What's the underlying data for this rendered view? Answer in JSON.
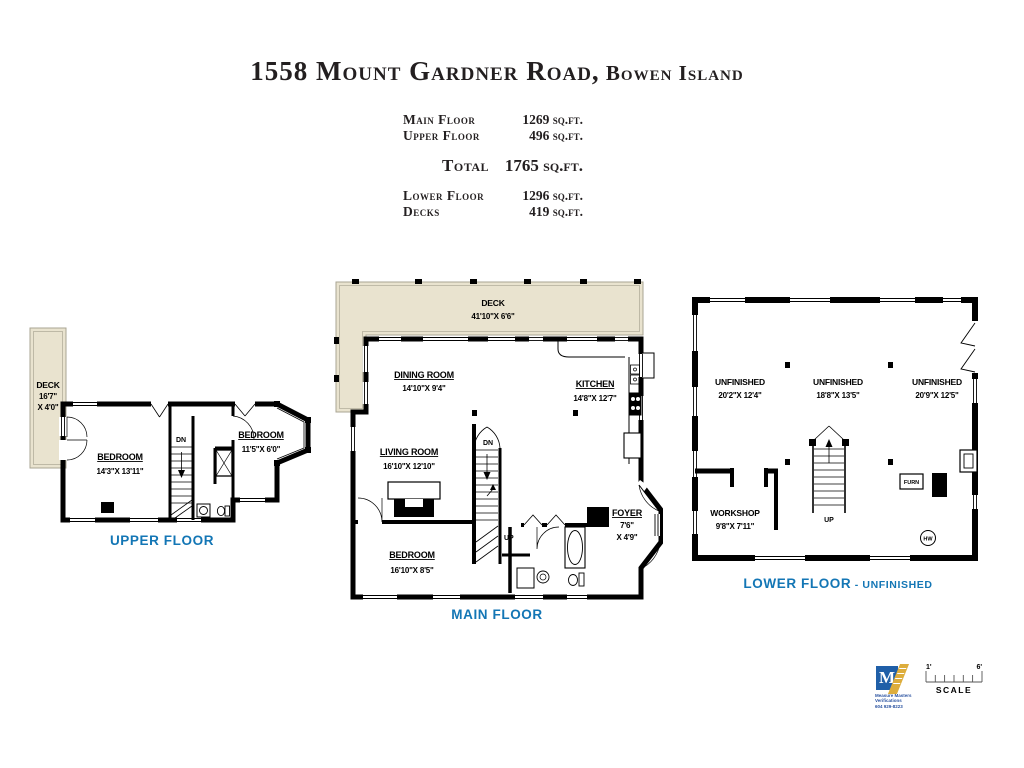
{
  "title": {
    "address": "1558 Mount Gardner Road,",
    "city": " Bowen Island"
  },
  "area_table": {
    "rows_top": [
      {
        "label": "Main Floor",
        "value": "1269 sq.ft."
      },
      {
        "label": "Upper Floor",
        "value": "496 sq.ft."
      }
    ],
    "total_label": "Total",
    "total_value": "1765 sq.ft.",
    "rows_bottom": [
      {
        "label": "Lower Floor",
        "value": "1296 sq.ft."
      },
      {
        "label": "Decks",
        "value": "419 sq.ft."
      }
    ]
  },
  "upper_floor": {
    "caption": "UPPER FLOOR",
    "deck_label": "DECK",
    "deck_dim_1": "16'7\"",
    "deck_dim_2": "X  4'0\"",
    "bedroom1_name": "BEDROOM",
    "bedroom1_dims": "14'3\"X  13'11\"",
    "bedroom2_name": "BEDROOM",
    "bedroom2_dims": "11'5\"X  6'0\"",
    "stairs_down": "DN"
  },
  "main_floor": {
    "caption": "MAIN FLOOR",
    "deck_label": "DECK",
    "deck_dims": "41'10\"X  6'6\"",
    "dining_name": "DINING  ROOM",
    "dining_dims": "14'10\"X  9'4\"",
    "kitchen_name": "KITCHEN",
    "kitchen_dims": "14'8\"X  12'7\"",
    "living_name": "LIVING  ROOM",
    "living_dims": "16'10\"X  12'10\"",
    "bedroom_name": "BEDROOM",
    "bedroom_dims": "16'10\"X  8'5\"",
    "foyer_name": "FOYER",
    "foyer_dim_1": "7'6\"",
    "foyer_dim_2": "X  4'9\"",
    "stairs_down": "DN",
    "stairs_up": "UP"
  },
  "lower_floor": {
    "caption": "LOWER FLOOR",
    "caption_suffix": " - UNFINISHED",
    "unfinished1_name": "UNFINISHED",
    "unfinished1_dims": "20'2\"X  12'4\"",
    "unfinished2_name": "UNFINISHED",
    "unfinished2_dims": "18'8\"X  13'5\"",
    "unfinished3_name": "UNFINISHED",
    "unfinished3_dims": "20'9\"X  12'5\"",
    "workshop_name": "WORKSHOP",
    "workshop_dims": "9'8\"X  7'11\"",
    "furnace_label": "FURN",
    "hot_water_label": "HW",
    "stairs_up": "UP"
  },
  "scale_bar": {
    "left_label": "1'",
    "right_label": "6'",
    "label": "SCALE"
  },
  "logo": {
    "monogram": "M",
    "line1": "Measure Masters Verifications",
    "line2": "604 929-8223"
  },
  "colors": {
    "accent_blue": "#1376b5",
    "deck_fill": "#e9e3cf",
    "wall": "#000000",
    "logo_blue": "#1f5fa8",
    "logo_gold": "#ddad3c"
  }
}
